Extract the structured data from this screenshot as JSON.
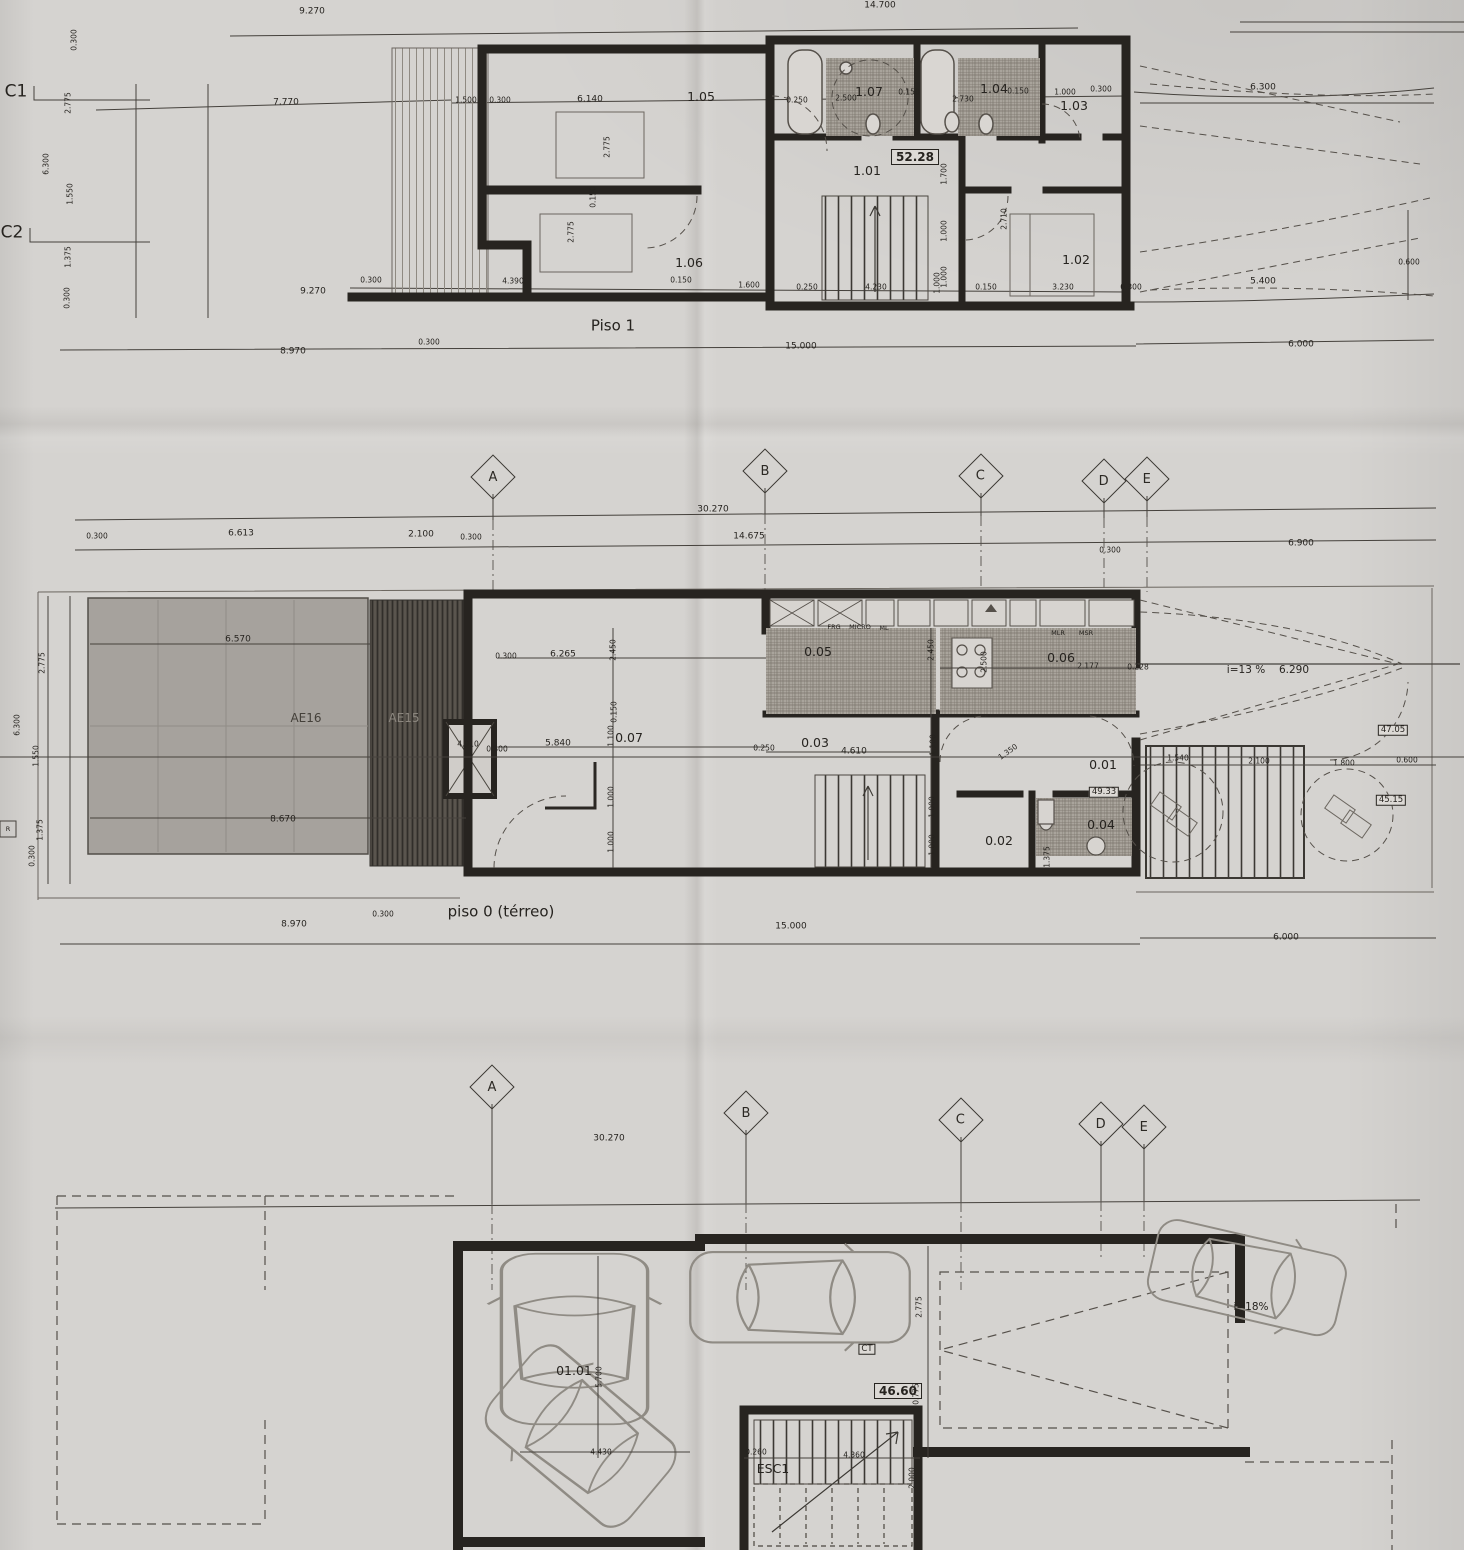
{
  "sheet": {
    "floors": [
      {
        "title": "Piso 1",
        "area_badge": "52.28",
        "rooms": [
          "1.01",
          "1.02",
          "1.03",
          "1.04",
          "1.05",
          "1.06",
          "1.07"
        ]
      },
      {
        "title": "piso 0 (térreo)",
        "area_badges": [
          "47.05",
          "45.15",
          "49.33"
        ],
        "rooms": [
          "0.01",
          "0.02",
          "0.03",
          "0.04",
          "0.05",
          "0.06",
          "0.07"
        ],
        "outdoor_zones": [
          "AE16",
          "AE15"
        ],
        "ramp_slope": "i=13 %"
      },
      {
        "area_badge": "46.60",
        "rooms": [
          "01.01"
        ],
        "stair_label": "ESC1",
        "equipment_badge": "CT",
        "ramp_slope": "i=18%"
      }
    ],
    "section_markers": [
      "C1",
      "C2"
    ]
  },
  "grid_rows": [
    {
      "letters": [
        {
          "ch": "A",
          "x": 493,
          "y": 477
        },
        {
          "ch": "B",
          "x": 765,
          "y": 471
        },
        {
          "ch": "C",
          "x": 981,
          "y": 476
        },
        {
          "ch": "D",
          "x": 1104,
          "y": 481
        },
        {
          "ch": "E",
          "x": 1147,
          "y": 479
        }
      ]
    },
    {
      "letters": [
        {
          "ch": "A",
          "x": 492,
          "y": 1087
        },
        {
          "ch": "B",
          "x": 746,
          "y": 1113
        },
        {
          "ch": "C",
          "x": 961,
          "y": 1120
        },
        {
          "ch": "D",
          "x": 1101,
          "y": 1124
        },
        {
          "ch": "E",
          "x": 1144,
          "y": 1127
        }
      ]
    }
  ],
  "labels": [
    {
      "t": "9.270",
      "x": 312,
      "y": 12
    },
    {
      "t": "14.700",
      "x": 880,
      "y": 6
    },
    {
      "t": "C1",
      "x": 16,
      "y": 92,
      "c": "g"
    },
    {
      "t": "7.770",
      "x": 286,
      "y": 103
    },
    {
      "t": "0.300",
      "x": 74,
      "y": 40,
      "r": -90,
      "c": "s"
    },
    {
      "t": "2.775",
      "x": 68,
      "y": 103,
      "r": -90,
      "c": "s"
    },
    {
      "t": "6.300",
      "x": 46,
      "y": 164,
      "r": -90,
      "c": "s"
    },
    {
      "t": "1.550",
      "x": 70,
      "y": 194,
      "r": -90,
      "c": "s"
    },
    {
      "t": "C2",
      "x": 12,
      "y": 233,
      "c": "g"
    },
    {
      "t": "1.375",
      "x": 68,
      "y": 257,
      "r": -90,
      "c": "s"
    },
    {
      "t": "0.300",
      "x": 67,
      "y": 298,
      "r": -90,
      "c": "s"
    },
    {
      "t": "9.270",
      "x": 313,
      "y": 292
    },
    {
      "t": "1.500",
      "x": 466,
      "y": 100,
      "c": "s"
    },
    {
      "t": "0.300",
      "x": 500,
      "y": 100,
      "c": "s"
    },
    {
      "t": "6.140",
      "x": 590,
      "y": 100
    },
    {
      "t": "1.05",
      "x": 701,
      "y": 97,
      "c": "r"
    },
    {
      "t": "2.775",
      "x": 607,
      "y": 147,
      "r": -90,
      "c": "s"
    },
    {
      "t": "0.150",
      "x": 593,
      "y": 197,
      "r": -90,
      "c": "s"
    },
    {
      "t": "2.775",
      "x": 571,
      "y": 232,
      "r": -90,
      "c": "s"
    },
    {
      "t": "1.06",
      "x": 689,
      "y": 263,
      "c": "r"
    },
    {
      "t": "0.250",
      "x": 797,
      "y": 100,
      "c": "s"
    },
    {
      "t": "2.500",
      "x": 846,
      "y": 98,
      "c": "s"
    },
    {
      "t": "1.07",
      "x": 869,
      "y": 92,
      "c": "r"
    },
    {
      "t": "0.150",
      "x": 909,
      "y": 92,
      "c": "s"
    },
    {
      "t": "2.730",
      "x": 963,
      "y": 99,
      "c": "s"
    },
    {
      "t": "1.04",
      "x": 994,
      "y": 89,
      "c": "r"
    },
    {
      "t": "0.150",
      "x": 1018,
      "y": 91,
      "c": "s"
    },
    {
      "t": "1.000",
      "x": 1065,
      "y": 92,
      "c": "s"
    },
    {
      "t": "0.300",
      "x": 1101,
      "y": 89,
      "c": "s"
    },
    {
      "t": "1.03",
      "x": 1074,
      "y": 106,
      "c": "r"
    },
    {
      "t": "6.300",
      "x": 1263,
      "y": 88
    },
    {
      "t": "52.28",
      "x": 915,
      "y": 157,
      "c": "b"
    },
    {
      "t": "1.01",
      "x": 867,
      "y": 171,
      "c": "r"
    },
    {
      "t": "1.700",
      "x": 944,
      "y": 174,
      "r": -90,
      "c": "s"
    },
    {
      "t": "1.000",
      "x": 944,
      "y": 231,
      "r": -90,
      "c": "s"
    },
    {
      "t": "1.000",
      "x": 944,
      "y": 277,
      "r": -90,
      "c": "s"
    },
    {
      "t": "2.710",
      "x": 1004,
      "y": 219,
      "r": -90,
      "c": "s"
    },
    {
      "t": "1.02",
      "x": 1076,
      "y": 260,
      "c": "r"
    },
    {
      "t": "0.300",
      "x": 371,
      "y": 280,
      "c": "s"
    },
    {
      "t": "4.390",
      "x": 513,
      "y": 281,
      "c": "s"
    },
    {
      "t": "0.150",
      "x": 681,
      "y": 280,
      "c": "s"
    },
    {
      "t": "1.600",
      "x": 749,
      "y": 285,
      "c": "s"
    },
    {
      "t": "0.250",
      "x": 807,
      "y": 287,
      "c": "s"
    },
    {
      "t": "4.230",
      "x": 876,
      "y": 287,
      "c": "s"
    },
    {
      "t": "1.000",
      "x": 937,
      "y": 283,
      "r": -90,
      "c": "s"
    },
    {
      "t": "0.150",
      "x": 986,
      "y": 287,
      "c": "s"
    },
    {
      "t": "3.230",
      "x": 1063,
      "y": 287,
      "c": "s"
    },
    {
      "t": "0.300",
      "x": 1131,
      "y": 287,
      "c": "s"
    },
    {
      "t": "5.400",
      "x": 1263,
      "y": 282
    },
    {
      "t": "0.600",
      "x": 1409,
      "y": 262,
      "c": "s"
    },
    {
      "t": "Piso 1",
      "x": 613,
      "y": 326,
      "c": "t"
    },
    {
      "t": "0.300",
      "x": 429,
      "y": 342,
      "c": "s"
    },
    {
      "t": "8.970",
      "x": 293,
      "y": 352
    },
    {
      "t": "15.000",
      "x": 801,
      "y": 347
    },
    {
      "t": "6.000",
      "x": 1301,
      "y": 345
    },
    {
      "t": "30.270",
      "x": 713,
      "y": 510
    },
    {
      "t": "14.675",
      "x": 749,
      "y": 537
    },
    {
      "t": "0.300",
      "x": 97,
      "y": 536,
      "c": "s"
    },
    {
      "t": "6.613",
      "x": 241,
      "y": 534
    },
    {
      "t": "2.100",
      "x": 421,
      "y": 535
    },
    {
      "t": "0.300",
      "x": 471,
      "y": 537,
      "c": "s"
    },
    {
      "t": "0.300",
      "x": 1110,
      "y": 550,
      "c": "s"
    },
    {
      "t": "6.900",
      "x": 1301,
      "y": 544
    },
    {
      "t": "6.570",
      "x": 238,
      "y": 640
    },
    {
      "t": "AE16",
      "x": 306,
      "y": 718,
      "c": "a"
    },
    {
      "t": "AE15",
      "x": 404,
      "y": 718,
      "c": "a2"
    },
    {
      "t": "8.670",
      "x": 283,
      "y": 820
    },
    {
      "t": "0.300",
      "x": 506,
      "y": 656,
      "c": "s"
    },
    {
      "t": "6.265",
      "x": 563,
      "y": 655
    },
    {
      "t": "2.450",
      "x": 613,
      "y": 650,
      "r": -90,
      "c": "s"
    },
    {
      "t": "4.910",
      "x": 468,
      "y": 744,
      "c": "s"
    },
    {
      "t": "0.300",
      "x": 497,
      "y": 749,
      "c": "s"
    },
    {
      "t": "5.840",
      "x": 558,
      "y": 744
    },
    {
      "t": "0.150",
      "x": 614,
      "y": 712,
      "r": -90,
      "c": "s"
    },
    {
      "t": "1.100",
      "x": 611,
      "y": 736,
      "r": -90,
      "c": "s"
    },
    {
      "t": "0.07",
      "x": 629,
      "y": 738,
      "c": "r"
    },
    {
      "t": "1.000",
      "x": 611,
      "y": 797,
      "r": -90,
      "c": "s"
    },
    {
      "t": "1.000",
      "x": 611,
      "y": 842,
      "r": -90,
      "c": "s"
    },
    {
      "t": "FRG",
      "x": 834,
      "y": 627,
      "c": "y"
    },
    {
      "t": "MICRO",
      "x": 860,
      "y": 627,
      "c": "y"
    },
    {
      "t": "ML",
      "x": 884,
      "y": 628,
      "c": "y"
    },
    {
      "t": "0.05",
      "x": 818,
      "y": 652,
      "c": "r"
    },
    {
      "t": "2.450",
      "x": 931,
      "y": 650,
      "r": -90,
      "c": "s"
    },
    {
      "t": "2.500",
      "x": 984,
      "y": 662,
      "r": -90,
      "c": "s"
    },
    {
      "t": "MLR",
      "x": 1058,
      "y": 633,
      "c": "y"
    },
    {
      "t": "MSR",
      "x": 1086,
      "y": 633,
      "c": "y"
    },
    {
      "t": "0.06",
      "x": 1061,
      "y": 658,
      "c": "r"
    },
    {
      "t": "2.177",
      "x": 1088,
      "y": 666,
      "c": "s"
    },
    {
      "t": "0.228",
      "x": 1138,
      "y": 667,
      "c": "s"
    },
    {
      "t": "i=13 %",
      "x": 1246,
      "y": 670,
      "c": "n"
    },
    {
      "t": "6.290",
      "x": 1294,
      "y": 670,
      "c": "n"
    },
    {
      "t": "0.03",
      "x": 815,
      "y": 743,
      "c": "r"
    },
    {
      "t": "0.250",
      "x": 764,
      "y": 748,
      "c": "s"
    },
    {
      "t": "4.610",
      "x": 854,
      "y": 752
    },
    {
      "t": "1.100",
      "x": 933,
      "y": 745,
      "r": -90,
      "c": "s"
    },
    {
      "t": "1.000",
      "x": 932,
      "y": 807,
      "r": -90,
      "c": "s"
    },
    {
      "t": "1.000",
      "x": 932,
      "y": 845,
      "r": -90,
      "c": "s"
    },
    {
      "t": "1.350",
      "x": 1008,
      "y": 752,
      "r": -35,
      "c": "s"
    },
    {
      "t": "0.01",
      "x": 1103,
      "y": 765,
      "c": "r"
    },
    {
      "t": "49.33",
      "x": 1104,
      "y": 792,
      "c": "bs"
    },
    {
      "t": "0.04",
      "x": 1101,
      "y": 825,
      "c": "r"
    },
    {
      "t": "0.02",
      "x": 999,
      "y": 841,
      "c": "r"
    },
    {
      "t": "1.375",
      "x": 1047,
      "y": 857,
      "r": -90,
      "c": "s"
    },
    {
      "t": "1.540",
      "x": 1178,
      "y": 758,
      "c": "s"
    },
    {
      "t": "2.100",
      "x": 1259,
      "y": 761,
      "c": "s"
    },
    {
      "t": "1.800",
      "x": 1344,
      "y": 763,
      "c": "s"
    },
    {
      "t": "0.600",
      "x": 1407,
      "y": 760,
      "c": "s"
    },
    {
      "t": "47.05",
      "x": 1393,
      "y": 730,
      "c": "bs"
    },
    {
      "t": "45.15",
      "x": 1391,
      "y": 800,
      "c": "bs"
    },
    {
      "t": "2.775",
      "x": 42,
      "y": 663,
      "r": -90,
      "c": "s"
    },
    {
      "t": "6.300",
      "x": 17,
      "y": 725,
      "r": -90,
      "c": "s"
    },
    {
      "t": "1.550",
      "x": 36,
      "y": 756,
      "r": -90,
      "c": "s"
    },
    {
      "t": "1.375",
      "x": 40,
      "y": 830,
      "r": -90,
      "c": "s"
    },
    {
      "t": "0.300",
      "x": 32,
      "y": 856,
      "r": -90,
      "c": "s"
    },
    {
      "t": "R",
      "x": 8,
      "y": 829,
      "c": "y"
    },
    {
      "t": "piso 0 (térreo)",
      "x": 501,
      "y": 912,
      "c": "t"
    },
    {
      "t": "8.970",
      "x": 294,
      "y": 925
    },
    {
      "t": "0.300",
      "x": 383,
      "y": 914,
      "c": "s"
    },
    {
      "t": "15.000",
      "x": 791,
      "y": 927
    },
    {
      "t": "6.000",
      "x": 1286,
      "y": 938
    },
    {
      "t": "30.270",
      "x": 609,
      "y": 1139
    },
    {
      "t": "01.01",
      "x": 574,
      "y": 1371,
      "c": "r"
    },
    {
      "t": "5.700",
      "x": 599,
      "y": 1377,
      "r": -90,
      "c": "s"
    },
    {
      "t": "4.430",
      "x": 601,
      "y": 1452,
      "c": "s"
    },
    {
      "t": "CT",
      "x": 867,
      "y": 1349,
      "c": "bs"
    },
    {
      "t": "46.60",
      "x": 898,
      "y": 1391,
      "c": "b"
    },
    {
      "t": "2.775",
      "x": 919,
      "y": 1307,
      "r": -90,
      "c": "s"
    },
    {
      "t": "0.775",
      "x": 916,
      "y": 1394,
      "r": -90,
      "c": "s"
    },
    {
      "t": "ESC1",
      "x": 773,
      "y": 1469,
      "c": "r"
    },
    {
      "t": "0.260",
      "x": 756,
      "y": 1452,
      "c": "s"
    },
    {
      "t": "4.360",
      "x": 854,
      "y": 1455,
      "c": "s"
    },
    {
      "t": "2.000",
      "x": 912,
      "y": 1478,
      "r": -90,
      "c": "s"
    },
    {
      "t": "i=18%",
      "x": 1251,
      "y": 1307,
      "c": "n"
    }
  ]
}
